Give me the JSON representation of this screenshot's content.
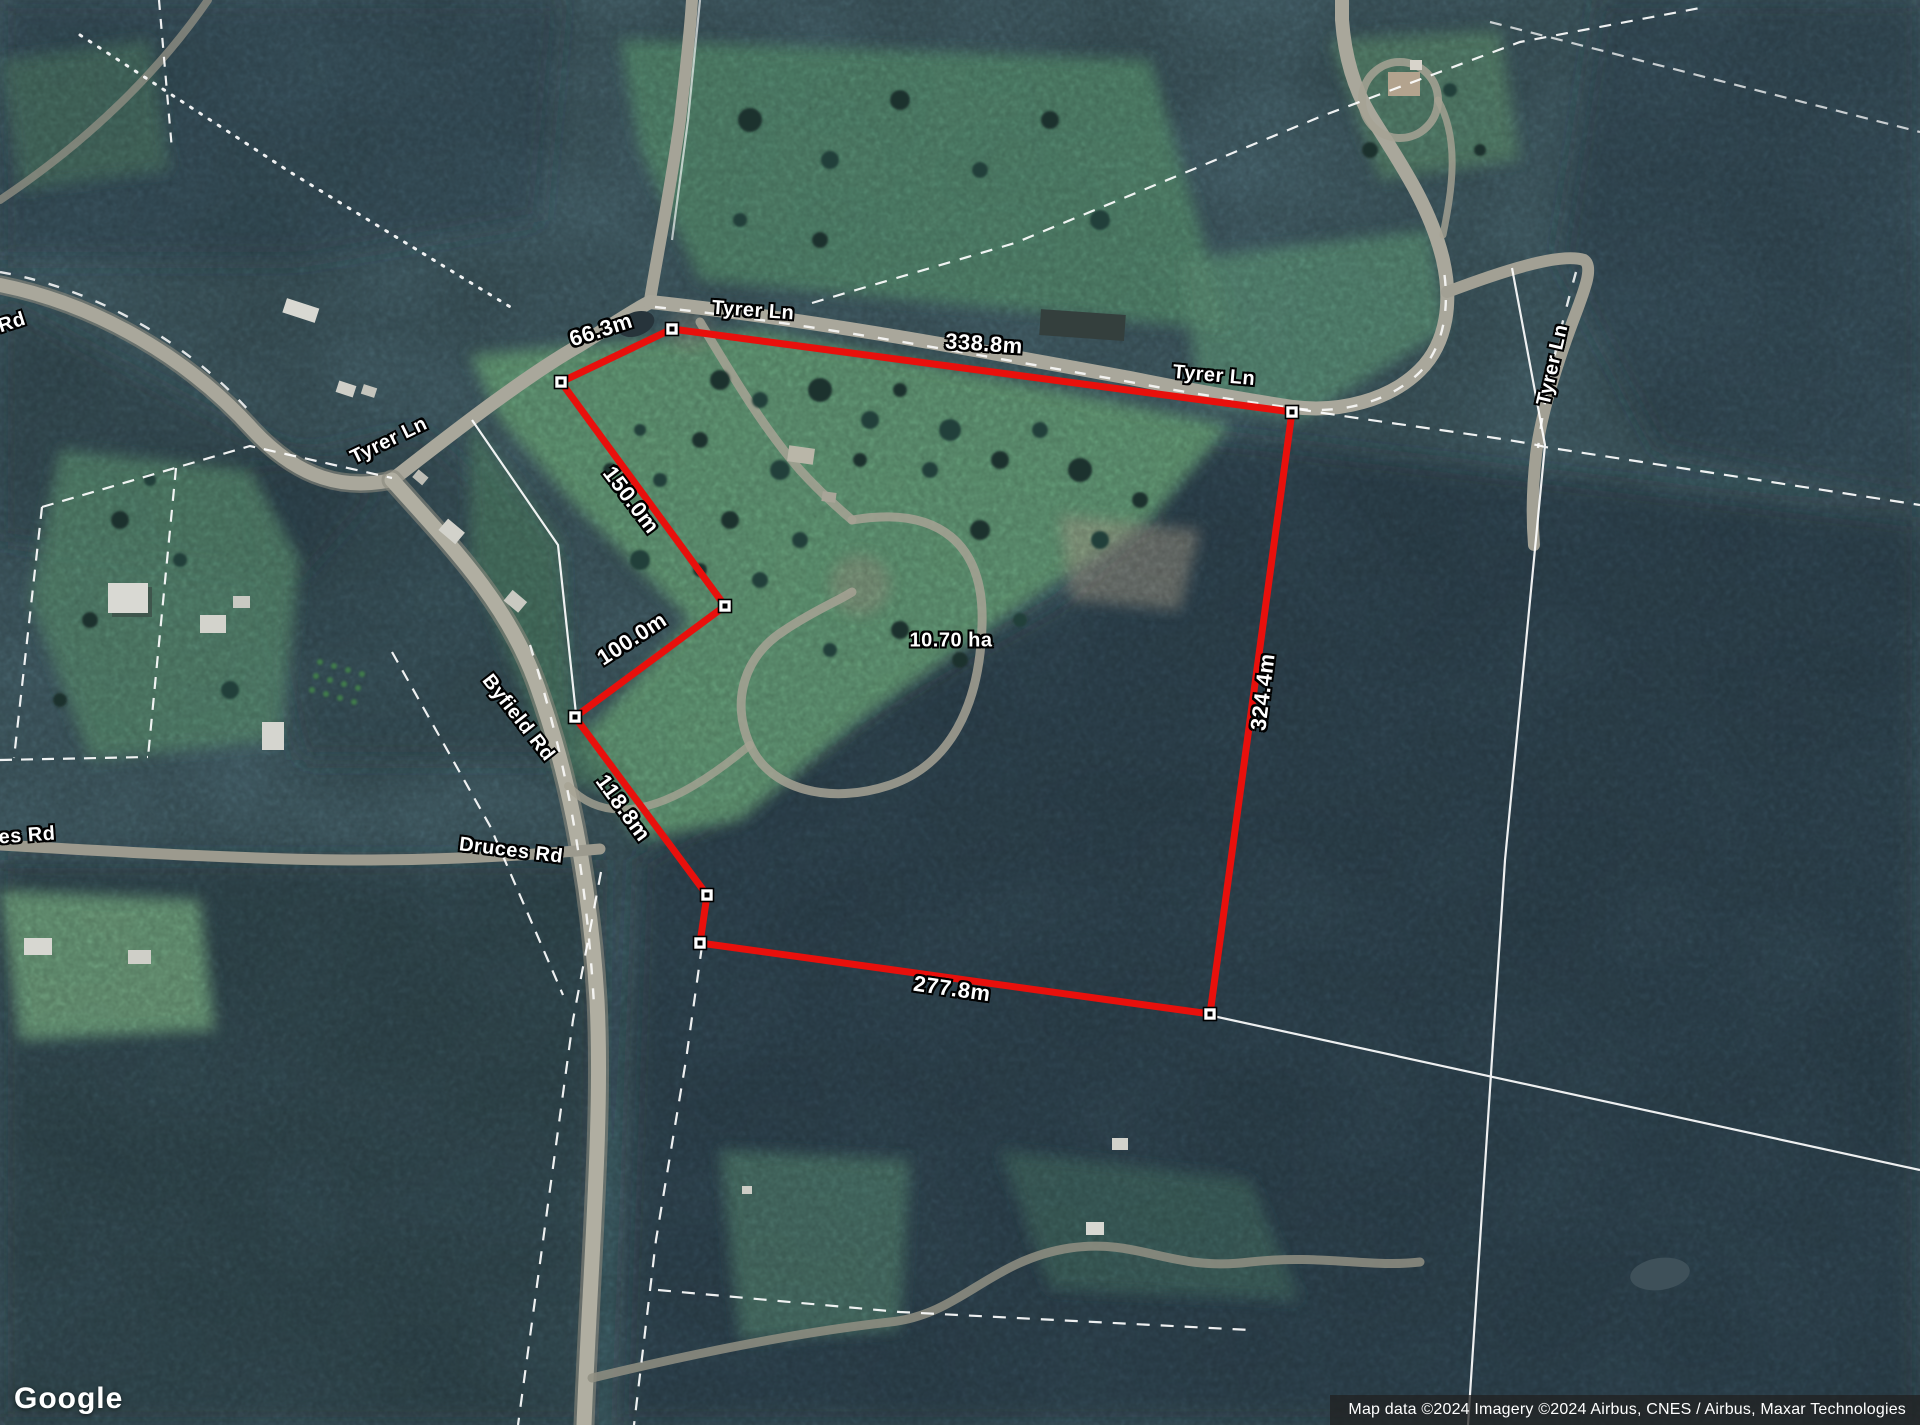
{
  "map": {
    "area_label": "10.70 ha",
    "measurements": {
      "top": "66.3m",
      "north": "338.8m",
      "east": "324.4m",
      "south": "277.8m",
      "southwest": "118.8m",
      "west_notch": "100.0m",
      "northwest": "150.0m"
    },
    "roads": {
      "tyrer_ln_top": "Tyrer Ln",
      "tyrer_ln_mid": "Tyrer Ln",
      "tyrer_ln_sw": "Tyrer Ln",
      "tyrer_ln_east": "Tyrer Ln",
      "byfield_rd": "Byfield Rd",
      "druces_rd": "Druces Rd",
      "druces_rd_left_edge": "es Rd",
      "rd_left_edge": "Rd"
    }
  },
  "branding": {
    "logo_text": "Google"
  },
  "attribution": {
    "text": "Map data ©2024 Imagery ©2024 Airbus, CNES / Airbus, Maxar Technologies"
  }
}
